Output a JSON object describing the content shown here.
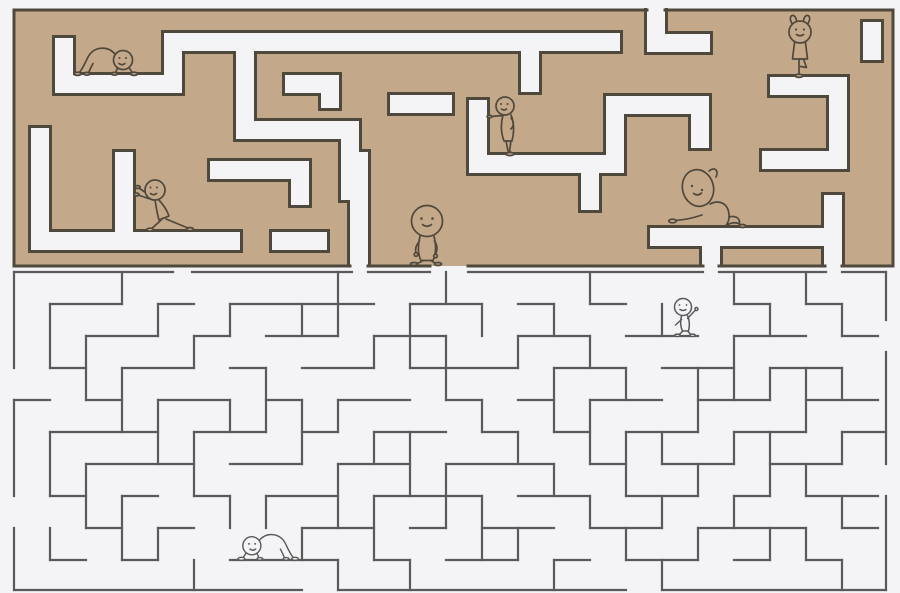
{
  "canvas": {
    "width": 900,
    "height": 593
  },
  "palette": {
    "background": "#f4f4f6",
    "wall_tan": "#c4a88a",
    "wall_outline": "#4f483c",
    "line_maze": "#5a5a5a",
    "figure_top_stroke": "#4f483c",
    "figure_top_fill": "#c4a88a",
    "figure_bottom_stroke": "#5a5a5a",
    "figure_bottom_fill": "#f4f4f6"
  },
  "top_maze": {
    "bounds": {
      "x": 14,
      "y": 10,
      "width": 879,
      "height": 256
    },
    "corridor_width": 18,
    "outline_width": 3,
    "boundary_segments": [
      [
        14,
        10,
        647,
        10
      ],
      [
        665,
        10,
        893,
        10
      ],
      [
        14,
        10,
        14,
        266
      ],
      [
        893,
        10,
        893,
        266
      ],
      [
        14,
        266,
        350,
        266
      ],
      [
        368,
        266,
        430,
        266
      ],
      [
        468,
        266,
        703,
        266
      ],
      [
        719,
        266,
        825,
        266
      ],
      [
        842,
        266,
        893,
        266
      ]
    ],
    "corridors": [
      {
        "x1": 656,
        "y1": 8,
        "x2": 656,
        "y2": 43,
        "c1": "o",
        "c2": "j"
      },
      {
        "x1": 656,
        "y1": 43,
        "x2": 710,
        "y2": 43,
        "c1": "j",
        "c2": "c"
      },
      {
        "x1": 64,
        "y1": 38,
        "x2": 64,
        "y2": 84,
        "c1": "c",
        "c2": "j"
      },
      {
        "x1": 64,
        "y1": 84,
        "x2": 173,
        "y2": 84,
        "c1": "j",
        "c2": "j"
      },
      {
        "x1": 173,
        "y1": 42,
        "x2": 173,
        "y2": 84,
        "c1": "j",
        "c2": "j"
      },
      {
        "x1": 173,
        "y1": 42,
        "x2": 620,
        "y2": 42,
        "c1": "j",
        "c2": "c"
      },
      {
        "x1": 245,
        "y1": 42,
        "x2": 245,
        "y2": 130,
        "c1": "j",
        "c2": "j"
      },
      {
        "x1": 245,
        "y1": 130,
        "x2": 350,
        "y2": 130,
        "c1": "j",
        "c2": "j"
      },
      {
        "x1": 350,
        "y1": 130,
        "x2": 350,
        "y2": 200,
        "c1": "j",
        "c2": "c"
      },
      {
        "x1": 285,
        "y1": 84,
        "x2": 330,
        "y2": 84,
        "c1": "c",
        "c2": "j"
      },
      {
        "x1": 330,
        "y1": 84,
        "x2": 330,
        "y2": 108,
        "c1": "j",
        "c2": "c"
      },
      {
        "x1": 40,
        "y1": 128,
        "x2": 40,
        "y2": 241,
        "c1": "c",
        "c2": "j"
      },
      {
        "x1": 40,
        "y1": 241,
        "x2": 240,
        "y2": 241,
        "c1": "j",
        "c2": "c"
      },
      {
        "x1": 124,
        "y1": 152,
        "x2": 124,
        "y2": 241,
        "c1": "c",
        "c2": "j"
      },
      {
        "x1": 272,
        "y1": 241,
        "x2": 327,
        "y2": 241,
        "c1": "c",
        "c2": "c"
      },
      {
        "x1": 359,
        "y1": 152,
        "x2": 359,
        "y2": 266,
        "c1": "c",
        "c2": "o"
      },
      {
        "x1": 469,
        "y1": 164,
        "x2": 615,
        "y2": 164,
        "c1": "c",
        "c2": "j"
      },
      {
        "x1": 615,
        "y1": 105,
        "x2": 615,
        "y2": 164,
        "c1": "j",
        "c2": "j"
      },
      {
        "x1": 615,
        "y1": 105,
        "x2": 700,
        "y2": 105,
        "c1": "j",
        "c2": "j"
      },
      {
        "x1": 700,
        "y1": 105,
        "x2": 700,
        "y2": 148,
        "c1": "j",
        "c2": "c"
      },
      {
        "x1": 478,
        "y1": 100,
        "x2": 478,
        "y2": 164,
        "c1": "c",
        "c2": "j"
      },
      {
        "x1": 390,
        "y1": 104,
        "x2": 452,
        "y2": 104,
        "c1": "c",
        "c2": "c"
      },
      {
        "x1": 770,
        "y1": 86,
        "x2": 838,
        "y2": 86,
        "c1": "c",
        "c2": "j"
      },
      {
        "x1": 838,
        "y1": 86,
        "x2": 838,
        "y2": 160,
        "c1": "j",
        "c2": "j"
      },
      {
        "x1": 762,
        "y1": 160,
        "x2": 838,
        "y2": 160,
        "c1": "c",
        "c2": "j"
      },
      {
        "x1": 872,
        "y1": 22,
        "x2": 872,
        "y2": 60,
        "c1": "c",
        "c2": "c"
      },
      {
        "x1": 650,
        "y1": 237,
        "x2": 833,
        "y2": 237,
        "c1": "c",
        "c2": "j"
      },
      {
        "x1": 833,
        "y1": 195,
        "x2": 833,
        "y2": 266,
        "c1": "c",
        "c2": "o"
      },
      {
        "x1": 711,
        "y1": 237,
        "x2": 711,
        "y2": 266,
        "c1": "j",
        "c2": "o"
      },
      {
        "x1": 530,
        "y1": 42,
        "x2": 530,
        "y2": 92,
        "c1": "j",
        "c2": "c"
      },
      {
        "x1": 590,
        "y1": 164,
        "x2": 590,
        "y2": 210,
        "c1": "j",
        "c2": "c"
      },
      {
        "x1": 210,
        "y1": 170,
        "x2": 300,
        "y2": 170,
        "c1": "c",
        "c2": "j"
      },
      {
        "x1": 300,
        "y1": 170,
        "x2": 300,
        "y2": 205,
        "c1": "j",
        "c2": "c"
      }
    ]
  },
  "bottom_maze": {
    "line_width": 2.2,
    "segments": [
      [
        14,
        272,
        173,
        272
      ],
      [
        192,
        272,
        352,
        272
      ],
      [
        368,
        272,
        430,
        272
      ],
      [
        468,
        272,
        703,
        272
      ],
      [
        719,
        272,
        826,
        272
      ],
      [
        842,
        272,
        886,
        272
      ],
      [
        14,
        272,
        14,
        368
      ],
      [
        14,
        400,
        14,
        496
      ],
      [
        14,
        528,
        14,
        590
      ],
      [
        886,
        272,
        886,
        320
      ],
      [
        886,
        352,
        886,
        464
      ],
      [
        886,
        496,
        886,
        590
      ],
      [
        14,
        590,
        302,
        590
      ],
      [
        338,
        590,
        626,
        590
      ],
      [
        662,
        590,
        886,
        590
      ],
      [
        50,
        304,
        122,
        304
      ],
      [
        158,
        304,
        194,
        304
      ],
      [
        230,
        304,
        374,
        304
      ],
      [
        410,
        304,
        482,
        304
      ],
      [
        518,
        304,
        554,
        304
      ],
      [
        590,
        304,
        626,
        304
      ],
      [
        734,
        304,
        770,
        304
      ],
      [
        806,
        304,
        842,
        304
      ],
      [
        86,
        336,
        158,
        336
      ],
      [
        194,
        336,
        230,
        336
      ],
      [
        266,
        336,
        338,
        336
      ],
      [
        374,
        336,
        446,
        336
      ],
      [
        518,
        336,
        590,
        336
      ],
      [
        626,
        336,
        698,
        336
      ],
      [
        734,
        336,
        806,
        336
      ],
      [
        842,
        336,
        878,
        336
      ],
      [
        50,
        368,
        86,
        368
      ],
      [
        122,
        368,
        194,
        368
      ],
      [
        230,
        368,
        266,
        368
      ],
      [
        302,
        368,
        374,
        368
      ],
      [
        410,
        368,
        518,
        368
      ],
      [
        554,
        368,
        626,
        368
      ],
      [
        662,
        368,
        734,
        368
      ],
      [
        770,
        368,
        842,
        368
      ],
      [
        14,
        400,
        50,
        400
      ],
      [
        86,
        400,
        122,
        400
      ],
      [
        158,
        400,
        230,
        400
      ],
      [
        266,
        400,
        302,
        400
      ],
      [
        338,
        400,
        410,
        400
      ],
      [
        446,
        400,
        482,
        400
      ],
      [
        518,
        400,
        554,
        400
      ],
      [
        590,
        400,
        662,
        400
      ],
      [
        698,
        400,
        770,
        400
      ],
      [
        806,
        400,
        878,
        400
      ],
      [
        50,
        432,
        158,
        432
      ],
      [
        194,
        432,
        266,
        432
      ],
      [
        302,
        432,
        338,
        432
      ],
      [
        374,
        432,
        446,
        432
      ],
      [
        482,
        432,
        518,
        432
      ],
      [
        554,
        432,
        590,
        432
      ],
      [
        626,
        432,
        698,
        432
      ],
      [
        734,
        432,
        806,
        432
      ],
      [
        842,
        432,
        886,
        432
      ],
      [
        86,
        464,
        194,
        464
      ],
      [
        230,
        464,
        302,
        464
      ],
      [
        338,
        464,
        410,
        464
      ],
      [
        446,
        464,
        554,
        464
      ],
      [
        590,
        464,
        626,
        464
      ],
      [
        662,
        464,
        734,
        464
      ],
      [
        770,
        464,
        842,
        464
      ],
      [
        50,
        496,
        86,
        496
      ],
      [
        122,
        496,
        158,
        496
      ],
      [
        194,
        496,
        230,
        496
      ],
      [
        266,
        496,
        338,
        496
      ],
      [
        374,
        496,
        482,
        496
      ],
      [
        518,
        496,
        590,
        496
      ],
      [
        626,
        496,
        698,
        496
      ],
      [
        734,
        496,
        770,
        496
      ],
      [
        806,
        496,
        878,
        496
      ],
      [
        86,
        528,
        122,
        528
      ],
      [
        158,
        528,
        194,
        528
      ],
      [
        302,
        528,
        374,
        528
      ],
      [
        410,
        528,
        446,
        528
      ],
      [
        482,
        528,
        554,
        528
      ],
      [
        590,
        528,
        662,
        528
      ],
      [
        698,
        528,
        806,
        528
      ],
      [
        842,
        528,
        878,
        528
      ],
      [
        50,
        560,
        86,
        560
      ],
      [
        122,
        560,
        158,
        560
      ],
      [
        230,
        560,
        338,
        560
      ],
      [
        374,
        560,
        410,
        560
      ],
      [
        446,
        560,
        518,
        560
      ],
      [
        554,
        560,
        590,
        560
      ],
      [
        626,
        560,
        698,
        560
      ],
      [
        734,
        560,
        770,
        560
      ],
      [
        806,
        560,
        842,
        560
      ],
      [
        50,
        304,
        50,
        368
      ],
      [
        50,
        432,
        50,
        496
      ],
      [
        50,
        528,
        50,
        560
      ],
      [
        86,
        336,
        86,
        400
      ],
      [
        86,
        464,
        86,
        528
      ],
      [
        122,
        272,
        122,
        304
      ],
      [
        122,
        368,
        122,
        432
      ],
      [
        122,
        496,
        122,
        560
      ],
      [
        158,
        304,
        158,
        336
      ],
      [
        158,
        400,
        158,
        464
      ],
      [
        158,
        528,
        158,
        560
      ],
      [
        194,
        336,
        194,
        368
      ],
      [
        194,
        432,
        194,
        496
      ],
      [
        194,
        560,
        194,
        590
      ],
      [
        230,
        304,
        230,
        336
      ],
      [
        230,
        400,
        230,
        432
      ],
      [
        230,
        496,
        230,
        528
      ],
      [
        266,
        368,
        266,
        432
      ],
      [
        266,
        496,
        266,
        528
      ],
      [
        302,
        304,
        302,
        336
      ],
      [
        302,
        400,
        302,
        464
      ],
      [
        302,
        528,
        302,
        560
      ],
      [
        338,
        272,
        338,
        336
      ],
      [
        338,
        400,
        338,
        432
      ],
      [
        338,
        464,
        338,
        528
      ],
      [
        338,
        560,
        338,
        590
      ],
      [
        374,
        336,
        374,
        368
      ],
      [
        374,
        432,
        374,
        464
      ],
      [
        374,
        496,
        374,
        560
      ],
      [
        410,
        304,
        410,
        368
      ],
      [
        410,
        432,
        410,
        496
      ],
      [
        410,
        560,
        410,
        590
      ],
      [
        446,
        272,
        446,
        304
      ],
      [
        446,
        336,
        446,
        400
      ],
      [
        446,
        464,
        446,
        528
      ],
      [
        482,
        304,
        482,
        336
      ],
      [
        482,
        400,
        482,
        432
      ],
      [
        482,
        496,
        482,
        560
      ],
      [
        518,
        336,
        518,
        368
      ],
      [
        518,
        432,
        518,
        464
      ],
      [
        518,
        528,
        518,
        560
      ],
      [
        554,
        304,
        554,
        336
      ],
      [
        554,
        368,
        554,
        432
      ],
      [
        554,
        464,
        554,
        496
      ],
      [
        554,
        560,
        554,
        590
      ],
      [
        590,
        272,
        590,
        304
      ],
      [
        590,
        336,
        590,
        368
      ],
      [
        590,
        400,
        590,
        464
      ],
      [
        590,
        496,
        590,
        528
      ],
      [
        626,
        368,
        626,
        400
      ],
      [
        626,
        432,
        626,
        496
      ],
      [
        626,
        528,
        626,
        560
      ],
      [
        662,
        304,
        662,
        336
      ],
      [
        662,
        432,
        662,
        464
      ],
      [
        662,
        496,
        662,
        528
      ],
      [
        662,
        560,
        662,
        590
      ],
      [
        698,
        368,
        698,
        432
      ],
      [
        698,
        464,
        698,
        496
      ],
      [
        698,
        528,
        698,
        560
      ],
      [
        734,
        272,
        734,
        304
      ],
      [
        734,
        336,
        734,
        400
      ],
      [
        734,
        432,
        734,
        464
      ],
      [
        734,
        496,
        734,
        528
      ],
      [
        770,
        304,
        770,
        336
      ],
      [
        770,
        368,
        770,
        400
      ],
      [
        770,
        432,
        770,
        496
      ],
      [
        770,
        528,
        770,
        560
      ],
      [
        806,
        272,
        806,
        304
      ],
      [
        806,
        368,
        806,
        432
      ],
      [
        806,
        464,
        806,
        496
      ],
      [
        806,
        528,
        806,
        560
      ],
      [
        842,
        304,
        842,
        336
      ],
      [
        842,
        368,
        842,
        400
      ],
      [
        842,
        432,
        842,
        464
      ],
      [
        842,
        496,
        842,
        528
      ],
      [
        842,
        560,
        842,
        590
      ]
    ]
  },
  "figures": [
    {
      "id": "crawler-top-left",
      "pose": "crawl",
      "x": 106,
      "y": 75,
      "scale": 1,
      "flip": false,
      "zone": "top"
    },
    {
      "id": "wall-pusher",
      "pose": "push",
      "x": 150,
      "y": 231,
      "scale": 1,
      "flip": false,
      "zone": "top"
    },
    {
      "id": "walker",
      "pose": "walk",
      "x": 427,
      "y": 265,
      "scale": 1,
      "flip": false,
      "zone": "top"
    },
    {
      "id": "pointer",
      "pose": "point",
      "x": 507,
      "y": 155,
      "scale": 1,
      "flip": false,
      "zone": "top"
    },
    {
      "id": "tree-poser",
      "pose": "tree",
      "x": 800,
      "y": 77,
      "scale": 1,
      "flip": false,
      "zone": "top"
    },
    {
      "id": "side-stretcher",
      "pose": "stretch",
      "x": 706,
      "y": 228,
      "scale": 1,
      "flip": false,
      "zone": "top"
    },
    {
      "id": "waver",
      "pose": "wave",
      "x": 684,
      "y": 336,
      "scale": 1,
      "flip": false,
      "zone": "bottom"
    },
    {
      "id": "crawler-bottom",
      "pose": "crawl",
      "x": 268,
      "y": 560,
      "scale": 0.95,
      "flip": true,
      "zone": "bottom"
    }
  ]
}
